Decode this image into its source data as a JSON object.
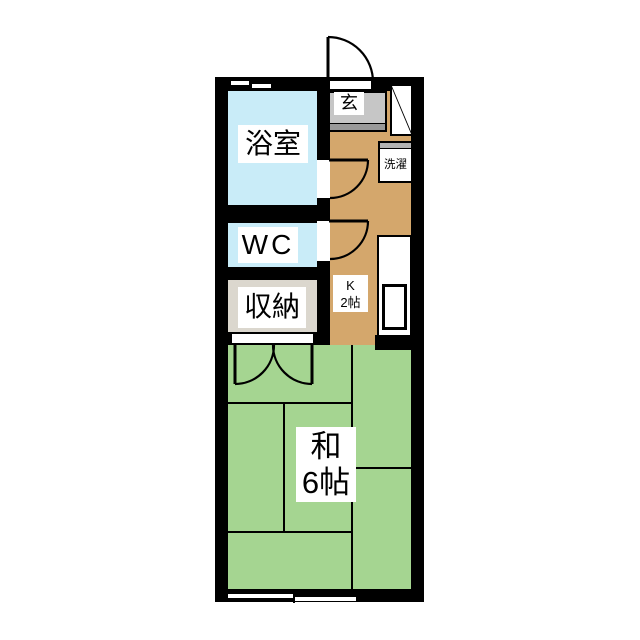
{
  "floorplan": {
    "type": "japanese-apartment-1K-floorplan",
    "rooms": {
      "bathroom": {
        "label": "浴室"
      },
      "toilet": {
        "label": "WC"
      },
      "storage": {
        "label": "収納"
      },
      "entrance": {
        "label": "玄"
      },
      "laundry": {
        "label": "洗濯"
      },
      "kitchen": {
        "label_top": "K",
        "label_bottom": "2帖"
      },
      "japanese_room": {
        "label_top": "和",
        "label_bottom": "6帖"
      }
    },
    "colors": {
      "wall": "#000000",
      "background": "#ffffff",
      "bathroom_floor": "#c9ecf8",
      "toilet_floor": "#c9ecf8",
      "storage_floor": "#dbd7ce",
      "kitchen_floor": "#d4a76c",
      "tatami_floor": "#a5d591",
      "entrance_floor": "#c6c6c6",
      "entrance_step": "#999999",
      "laundry_strip": "#b3b3b3"
    }
  }
}
